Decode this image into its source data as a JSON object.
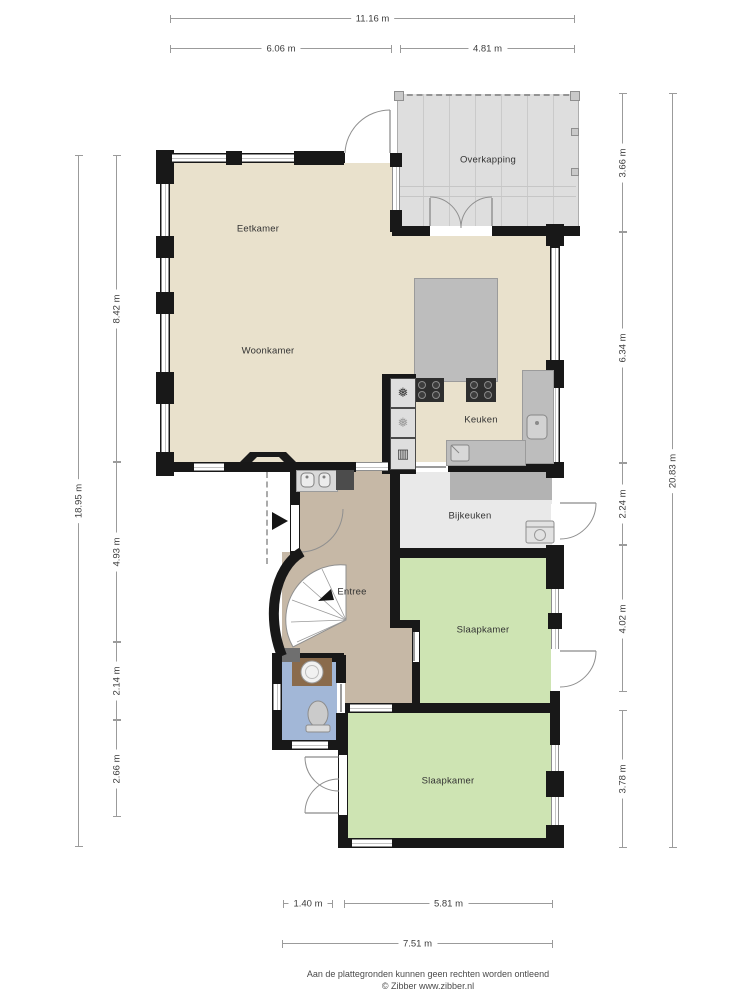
{
  "rooms": {
    "eetkamer": {
      "label": "Eetkamer"
    },
    "woonkamer": {
      "label": "Woonkamer"
    },
    "keuken": {
      "label": "Keuken"
    },
    "overkapping": {
      "label": "Overkapping"
    },
    "bijkeuken": {
      "label": "Bijkeuken"
    },
    "entree": {
      "label": "Entree"
    },
    "slaapkamer_1": {
      "label": "Slaapkamer"
    },
    "slaapkamer_2": {
      "label": "Slaapkamer"
    }
  },
  "dimensions": {
    "top_total": "11.16 m",
    "top_left": "6.06 m",
    "top_right": "4.81 m",
    "left_total": "18.95 m",
    "left_segments": [
      "8.42 m",
      "4.93 m",
      "2.14 m",
      "2.66 m"
    ],
    "right_total": "20.83 m",
    "right_segments": [
      "3.66 m",
      "6.34 m",
      "2.24 m",
      "4.02 m",
      "3.78 m"
    ],
    "bottom_left": "1.40 m",
    "bottom_right": "5.81 m",
    "bottom_total": "7.51 m"
  },
  "icons": {
    "freezer": "❅",
    "fridge": "❅",
    "oven": "▥"
  },
  "footer": {
    "disclaimer": "Aan de plattegronden kunnen geen rechten worden ontleend",
    "copyright": "© Zibber www.zibber.nl"
  },
  "colors": {
    "wall": "#181818",
    "living_floor": "#e9e1cc",
    "hall_floor": "#c6b8a6",
    "bedroom_floor": "#cee4b3",
    "toilet_floor": "#a2b7d7",
    "utility_floor": "#e9e9e9",
    "counter": "#b3b3b3",
    "overkapping_floor": "#dedede"
  }
}
